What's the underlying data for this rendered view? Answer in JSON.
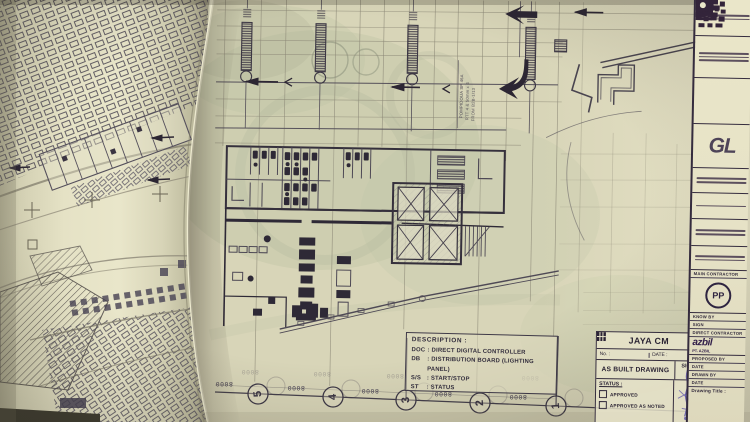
{
  "colors": {
    "paper": "#d8d5b8",
    "paper_bright": "#eae6c9",
    "paper_shadow": "#95917a",
    "ink": "#3e3947",
    "ink_strong": "#2c2633",
    "logo_purple": "#33243a",
    "tint_green": "#b4bf9e",
    "signature_ink": "#584ea6"
  },
  "plan": {
    "grid_bubbles": [
      "5",
      "4",
      "3",
      "2",
      "1"
    ],
    "dim_label": "8000",
    "riser_note": [
      "POMPIDOUA SP 46A",
      "RTT 4 & 50mm x 4",
      "FROM B2B-1/13"
    ]
  },
  "description_box": {
    "title": "DESCRIPTION :",
    "entries": [
      {
        "abbr": "DOC",
        "text": ": DIRECT DIGITAL CONTROLLER"
      },
      {
        "abbr": "DB",
        "text": ": DISTRIBUTION BOARD (LIGHTING PANEL)"
      },
      {
        "abbr": "S/S",
        "text": ": START/STOP"
      },
      {
        "abbr": "ST",
        "text": ": STATUS"
      }
    ]
  },
  "jaya_block": {
    "company": "JAYA CM",
    "no_label": "No. :",
    "date_label": "DATE :",
    "drawing_type": "AS BUILT DRAWING",
    "sign_label": "SIGN",
    "status_label": "STATUS :",
    "checkbox_approved": "APPROVED",
    "checkbox_approved_as_noted": "APPROVED AS NOTED"
  },
  "title_column": {
    "gl_logo_text": "GL",
    "main_contractor_label": "MAIN CONTRACTOR",
    "pp_logo_text": "PP",
    "know_by_label": "KNOW BY",
    "sign_label": "SIGN",
    "direct_contractor_label": "DIRECT CONTRACTOR",
    "azbil_logo_text": "azbil",
    "azbil_company": "PT. AZBIL",
    "rows": [
      "PROPOSED BY",
      "DATE",
      "DRAWN BY",
      "DATE"
    ],
    "drawing_title_label": "Drawing Title :"
  }
}
